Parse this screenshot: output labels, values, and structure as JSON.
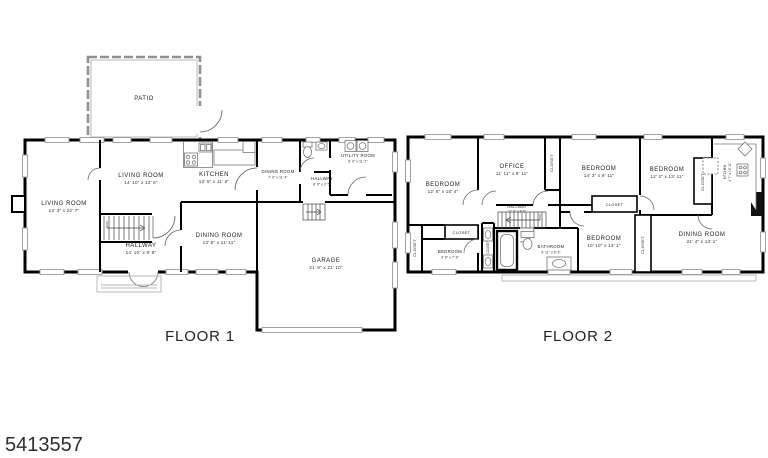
{
  "listing_id": "5413557",
  "floor1": {
    "label": "FLOOR 1",
    "rooms": {
      "patio": {
        "name": "PATIO",
        "dims": ""
      },
      "living_room_a": {
        "name": "LIVING ROOM",
        "dims": "13' 3\" x 22' 7\""
      },
      "living_room_b": {
        "name": "LIVING ROOM",
        "dims": "14' 10\" x 13' 6\""
      },
      "kitchen": {
        "name": "KITCHEN",
        "dims": "13' 5\" x 11' 6\""
      },
      "dining_room_b": {
        "name": "DINING ROOM",
        "dims": "7' 9\" x 11' 4\""
      },
      "utility_room": {
        "name": "UTILITY ROOM",
        "dims": "8' 9\" x 11' 2\""
      },
      "hallway_b": {
        "name": "HALLWAY",
        "dims": "8' 0\" x 3' 5\""
      },
      "hallway_a": {
        "name": "HALLWAY",
        "dims": "14' 10\" x 9' 9\""
      },
      "dining_room_a": {
        "name": "DINING ROOM",
        "dims": "13' 5\" x 11' 11\""
      },
      "garage": {
        "name": "GARAGE",
        "dims": "21' 9\" x 21' 10\""
      }
    }
  },
  "floor2": {
    "label": "FLOOR 2",
    "closet_label": "CLOSET",
    "rooms": {
      "bedroom_a": {
        "name": "BEDROOM",
        "dims": "12' 6\" x 15' 4\""
      },
      "office": {
        "name": "OFFICE",
        "dims": "11' 11\" x 9' 11\""
      },
      "bedroom_b": {
        "name": "BEDROOM",
        "dims": "14' 3\" x 9' 11\""
      },
      "bedroom_c": {
        "name": "BEDROOM",
        "dims": "12' 2\" x 13' 11\""
      },
      "hallway": {
        "name": "HALLWAY",
        "dims": "17' 6\" x 8' 6\""
      },
      "bedroom_d": {
        "name": "BEDROOM",
        "dims": "9' 6\" x 7' 8\""
      },
      "bathroom": {
        "name": "BATHROOM",
        "dims": "9' 11\" x 6' 3\""
      },
      "bedroom_e": {
        "name": "BEDROOM",
        "dims": "10' 10\" x 13' 1\""
      },
      "dining_room": {
        "name": "DINING ROOM",
        "dims": "21' 4\" x 13' 1\""
      },
      "kitchen": {
        "name": "KITCHEN",
        "dims": "4' 7\" x 10' 11\""
      }
    }
  }
}
